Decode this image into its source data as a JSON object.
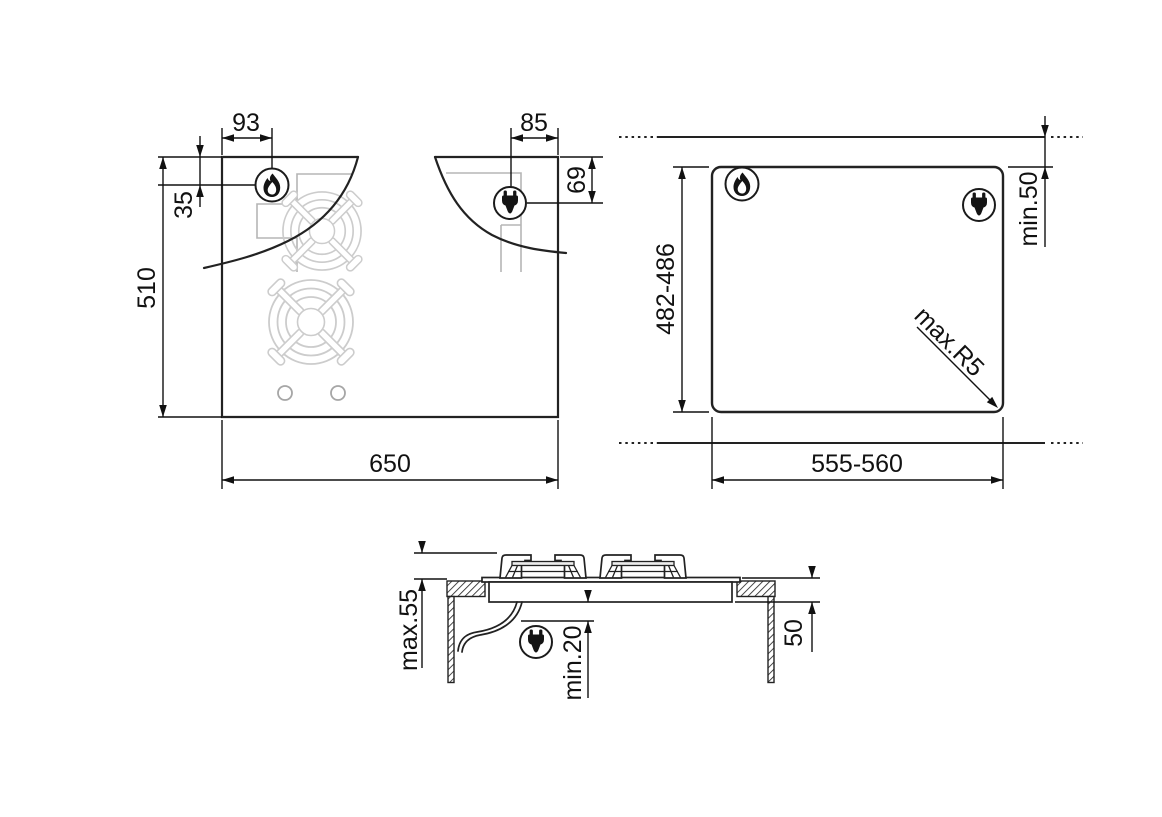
{
  "colors": {
    "outline": "#222222",
    "dim": "#111111",
    "construction": "#b5b5b5",
    "grid": "#cccccc"
  },
  "top_view": {
    "labels": {
      "burner_offset_left": "93",
      "socket_offset_right": "85",
      "burner_offset_top": "35",
      "socket_offset_top": "69",
      "depth": "510",
      "width": "650"
    }
  },
  "cutout_view": {
    "labels": {
      "cutout_depth": "482-486",
      "rear_clearance": "min.50",
      "corner_radius": "max.R5",
      "cutout_width": "555-560"
    }
  },
  "side_view": {
    "labels": {
      "height_overall": "max.55",
      "clearance_below": "min.20",
      "recess_depth": "50"
    }
  }
}
